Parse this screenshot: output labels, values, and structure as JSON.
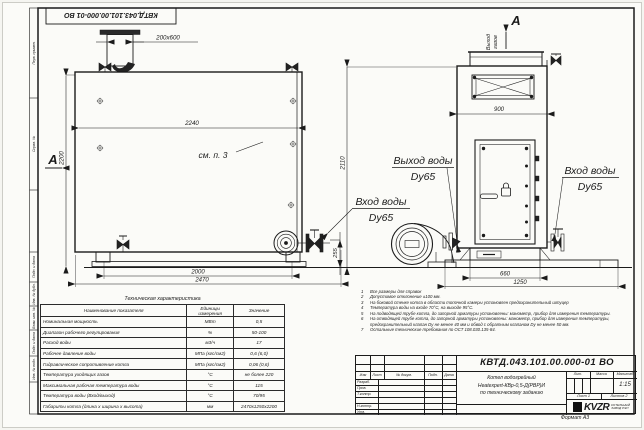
{
  "meta": {
    "doc_code": "КВТД.043.101.00.000-01 ВО",
    "format": "Формат А3"
  },
  "margin_fields": [
    "Перв. примен.",
    "Справ. №",
    "Подп. и дата",
    "Инв. № дубл.",
    "Взам. инв. №",
    "Подп. и дата",
    "Инв. № подл."
  ],
  "side_view": {
    "view_arrow": "А",
    "chimney_dim": "200х600",
    "ref_note": "см. п. 3",
    "dims": {
      "inner_width": "2240",
      "height_left": "2200",
      "height_right": "2110",
      "base": "2000",
      "overall": "2470",
      "stub": "255"
    }
  },
  "front_view": {
    "view_label": "А",
    "gas_out_line1": "Выход",
    "gas_out_line2": "газов",
    "dims": {
      "top": "900",
      "pedestal": "660",
      "overall": "1250"
    }
  },
  "labels": {
    "outlet_title": "Выход воды",
    "outlet_dn": "Dy65",
    "inlet_title": "Вход воды",
    "inlet_dn": "Dy65",
    "inlet2_title": "Вход воды",
    "inlet2_dn": "Dy65"
  },
  "notes": [
    {
      "num": "1",
      "text": "Все размеры для справок"
    },
    {
      "num": "2",
      "text": "Допустимое отклонение ±100 мм."
    },
    {
      "num": "3",
      "text": "На боковой стенке котла в области топочной камеры установлен предохранительный штуцер"
    },
    {
      "num": "4",
      "text": "Температура воды на входе 70°С, на выходе 95°С."
    },
    {
      "num": "5",
      "text": "На подводящей трубе котла, до запорной арматуры установлены: манометр, прибор для измерения температуры."
    },
    {
      "num": "6",
      "text": "На отводящей трубе котла, до запорной арматуры установлены: манометр, прибор для измерения температуры, предохранительный клапан Dу не менее 40 мм и обвод с обратным клапаном Dу не менее 50 мм."
    },
    {
      "num": "7",
      "text": "Остальные технические требования по ОСТ 108.030.135-84."
    }
  ],
  "spec": {
    "title": "Техническая характеристика",
    "col_name": "Наименование показателя",
    "col_units": "Единицы измерения",
    "col_value": "Значение",
    "rows": [
      {
        "n": "Номинальная мощность",
        "u": "МВт",
        "v": "0,5"
      },
      {
        "n": "Диапазон рабочего регулирования",
        "u": "%",
        "v": "50-100"
      },
      {
        "n": "Расход воды",
        "u": "м3/ч",
        "v": "17"
      },
      {
        "n": "Рабочее давление воды",
        "u": "МПа (кгс/см2)",
        "v": "0,6 (6,0)"
      },
      {
        "n": "Гидравлическое сопротивление котла",
        "u": "МПа (кгс/см2)",
        "v": "0,06 (0,6)"
      },
      {
        "n": "Температура уходящих газов",
        "u": "°С",
        "v": "не более 220"
      },
      {
        "n": "Максимальная рабочая температура воды",
        "u": "°С",
        "v": "115"
      },
      {
        "n": "Температура воды (Вход/выход)",
        "u": "°С",
        "v": "70/95"
      },
      {
        "n": "Габариты котла (длина х ширина х высота)",
        "u": "мм",
        "v": "2470х1250х2200"
      }
    ]
  },
  "title_block": {
    "doc_code": "КВТД.043.101.00.000-01 ВО",
    "product_line1": "Котел водогрейный",
    "product_line2": "Heatexpert-КВр-0,5-Д(РВР)И",
    "product_line3": "по техническому заданию",
    "col_izm": "Изм",
    "col_list": "Лист",
    "col_doc": "№ докум.",
    "col_podp": "Подп.",
    "col_data": "Дата",
    "row_razrab": "Разраб.",
    "row_prov": "Пров.",
    "row_tkontr": "Т.контр.",
    "row_nkontr": "Н.контр.",
    "row_utv": "Утв.",
    "lit": "Лит.",
    "massa": "Масса",
    "scale_label": "Масштаб",
    "scale": "1:15",
    "sheet_label": "Лист",
    "sheet": "1",
    "sheets_label": "Листов",
    "sheets": "2",
    "brand": "KVZR",
    "brand_sub1": "КОТЕЛЬНЫЙ",
    "brand_sub2": "ЗАВОД РЭП"
  }
}
